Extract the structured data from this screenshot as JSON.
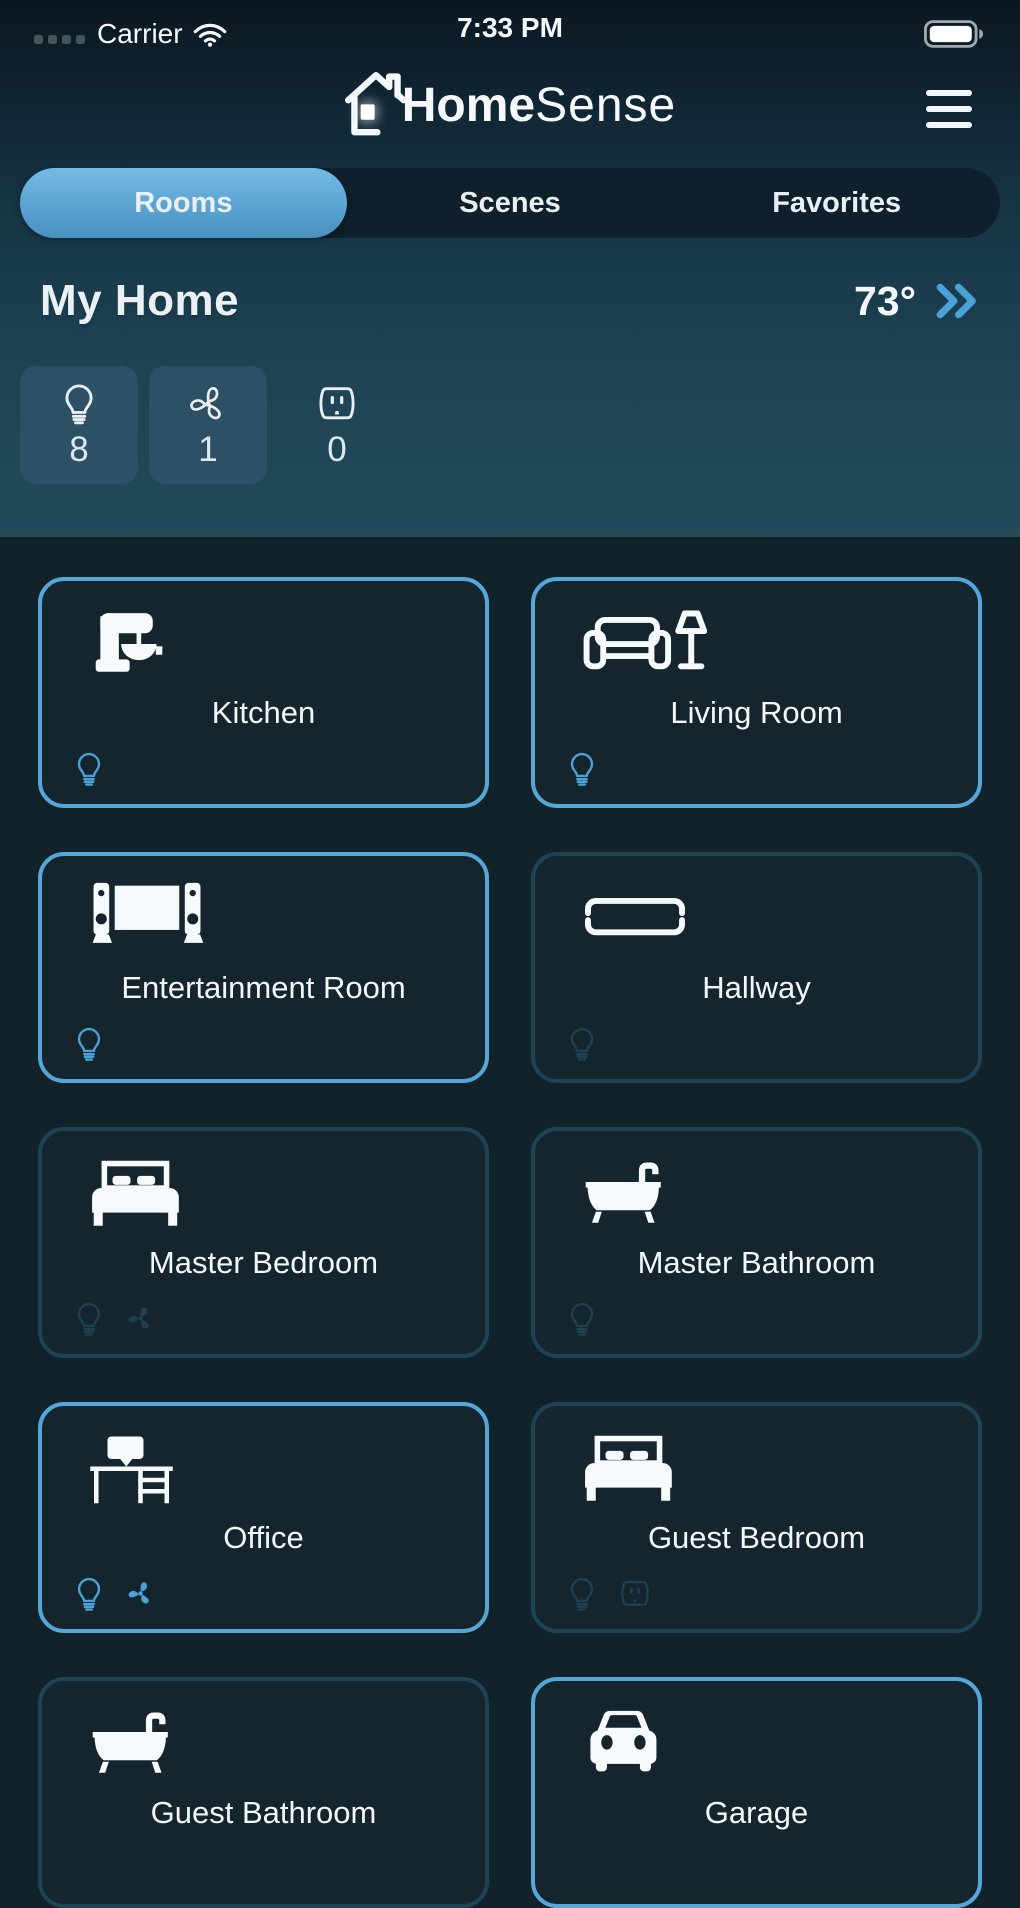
{
  "colors": {
    "accent_blue": "#4aa2d7",
    "active_border": "#55a7d9",
    "inactive_border": "#1e4355",
    "device_off": "#1d4151",
    "tab_active_top": "#74bce6",
    "tab_active_bottom": "#4891c0",
    "card_bg": "#15252d",
    "content_bg": "#12222a",
    "badge_bg": "#2d5164"
  },
  "status_bar": {
    "carrier": "Carrier",
    "time": "7:33 PM",
    "signal_icon": "signal-dots-icon",
    "wifi_icon": "wifi-icon",
    "battery_icon": "battery-icon"
  },
  "header": {
    "logo_icon": "house-logo-icon",
    "brand_bold": "Home",
    "brand_light": "Sense",
    "menu_icon": "menu-icon"
  },
  "tabs": [
    {
      "label": "Rooms",
      "active": true
    },
    {
      "label": "Scenes",
      "active": false
    },
    {
      "label": "Favorites",
      "active": false
    }
  ],
  "home": {
    "title": "My Home",
    "temperature": "73°",
    "chevron_icon": "chevrons-right-icon",
    "device_counts": [
      {
        "icon": "lightbulb-icon",
        "count": "8",
        "boxed": true
      },
      {
        "icon": "fan-icon",
        "count": "1",
        "boxed": true
      },
      {
        "icon": "outlet-icon",
        "count": "0",
        "boxed": false
      }
    ]
  },
  "rooms": [
    {
      "name": "Kitchen",
      "icon": "stand-mixer-icon",
      "active": true,
      "devices": [
        {
          "icon": "lightbulb-icon",
          "state": "on"
        }
      ]
    },
    {
      "name": "Living Room",
      "icon": "sofa-lamp-icon",
      "active": true,
      "devices": [
        {
          "icon": "lightbulb-icon",
          "state": "on"
        }
      ]
    },
    {
      "name": "Entertainment Room",
      "icon": "tv-speakers-icon",
      "active": true,
      "devices": [
        {
          "icon": "lightbulb-icon",
          "state": "on"
        }
      ]
    },
    {
      "name": "Hallway",
      "icon": "hallway-rug-icon",
      "active": false,
      "devices": [
        {
          "icon": "lightbulb-icon",
          "state": "off"
        }
      ]
    },
    {
      "name": "Master Bedroom",
      "icon": "bed-icon",
      "active": false,
      "devices": [
        {
          "icon": "lightbulb-icon",
          "state": "off"
        },
        {
          "icon": "fan-icon",
          "state": "off"
        }
      ]
    },
    {
      "name": "Master Bathroom",
      "icon": "bathtub-icon",
      "active": false,
      "devices": [
        {
          "icon": "lightbulb-icon",
          "state": "off"
        }
      ]
    },
    {
      "name": "Office",
      "icon": "desk-icon",
      "active": true,
      "devices": [
        {
          "icon": "lightbulb-icon",
          "state": "on"
        },
        {
          "icon": "fan-icon",
          "state": "on"
        }
      ]
    },
    {
      "name": "Guest Bedroom",
      "icon": "bed-icon",
      "active": false,
      "devices": [
        {
          "icon": "lightbulb-icon",
          "state": "off"
        },
        {
          "icon": "outlet-icon",
          "state": "off"
        }
      ]
    },
    {
      "name": "Guest Bathroom",
      "icon": "bathtub-icon",
      "active": false,
      "devices": []
    },
    {
      "name": "Garage",
      "icon": "car-icon",
      "active": true,
      "devices": []
    }
  ]
}
